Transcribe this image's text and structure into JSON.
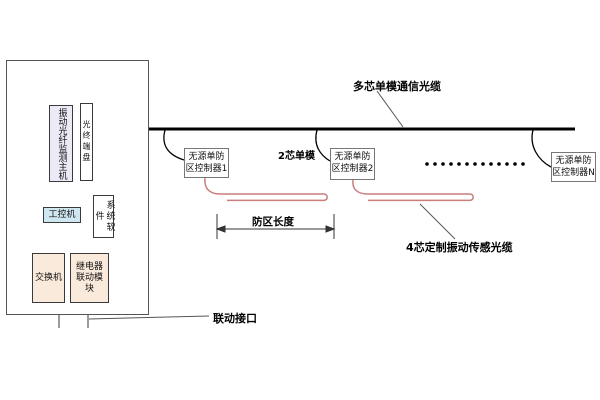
{
  "diagram": {
    "title_hint": "vibration-fiber-perimeter-security-system",
    "colors": {
      "trunk_cable": "#000000",
      "sensing_cable": "#c97d7d",
      "host_fill": "#eceaf6",
      "ipc_fill": "#cfe7f0",
      "module_fill": "#faeadb",
      "box_border": "#3a3a3a"
    },
    "cabinet": {
      "host": "振动光纤监测主机",
      "optical_terminal": "光终端盘",
      "ipc": "工控机",
      "software": "系统软件",
      "switch": "交换机",
      "relay_module": "继电器联动模块"
    },
    "controllers": [
      {
        "label": "无源单防区控制器1"
      },
      {
        "label": "无源单防区控制器2"
      },
      {
        "label": "无源单防区控制器N"
      }
    ],
    "labels": {
      "trunk_cable": "多芯单模通信光缆",
      "drop_fiber": "2芯单模",
      "sensing_cable": "4芯定制振动传感光缆",
      "zone_length": "防区长度",
      "linkage_port": "联动接口"
    }
  }
}
